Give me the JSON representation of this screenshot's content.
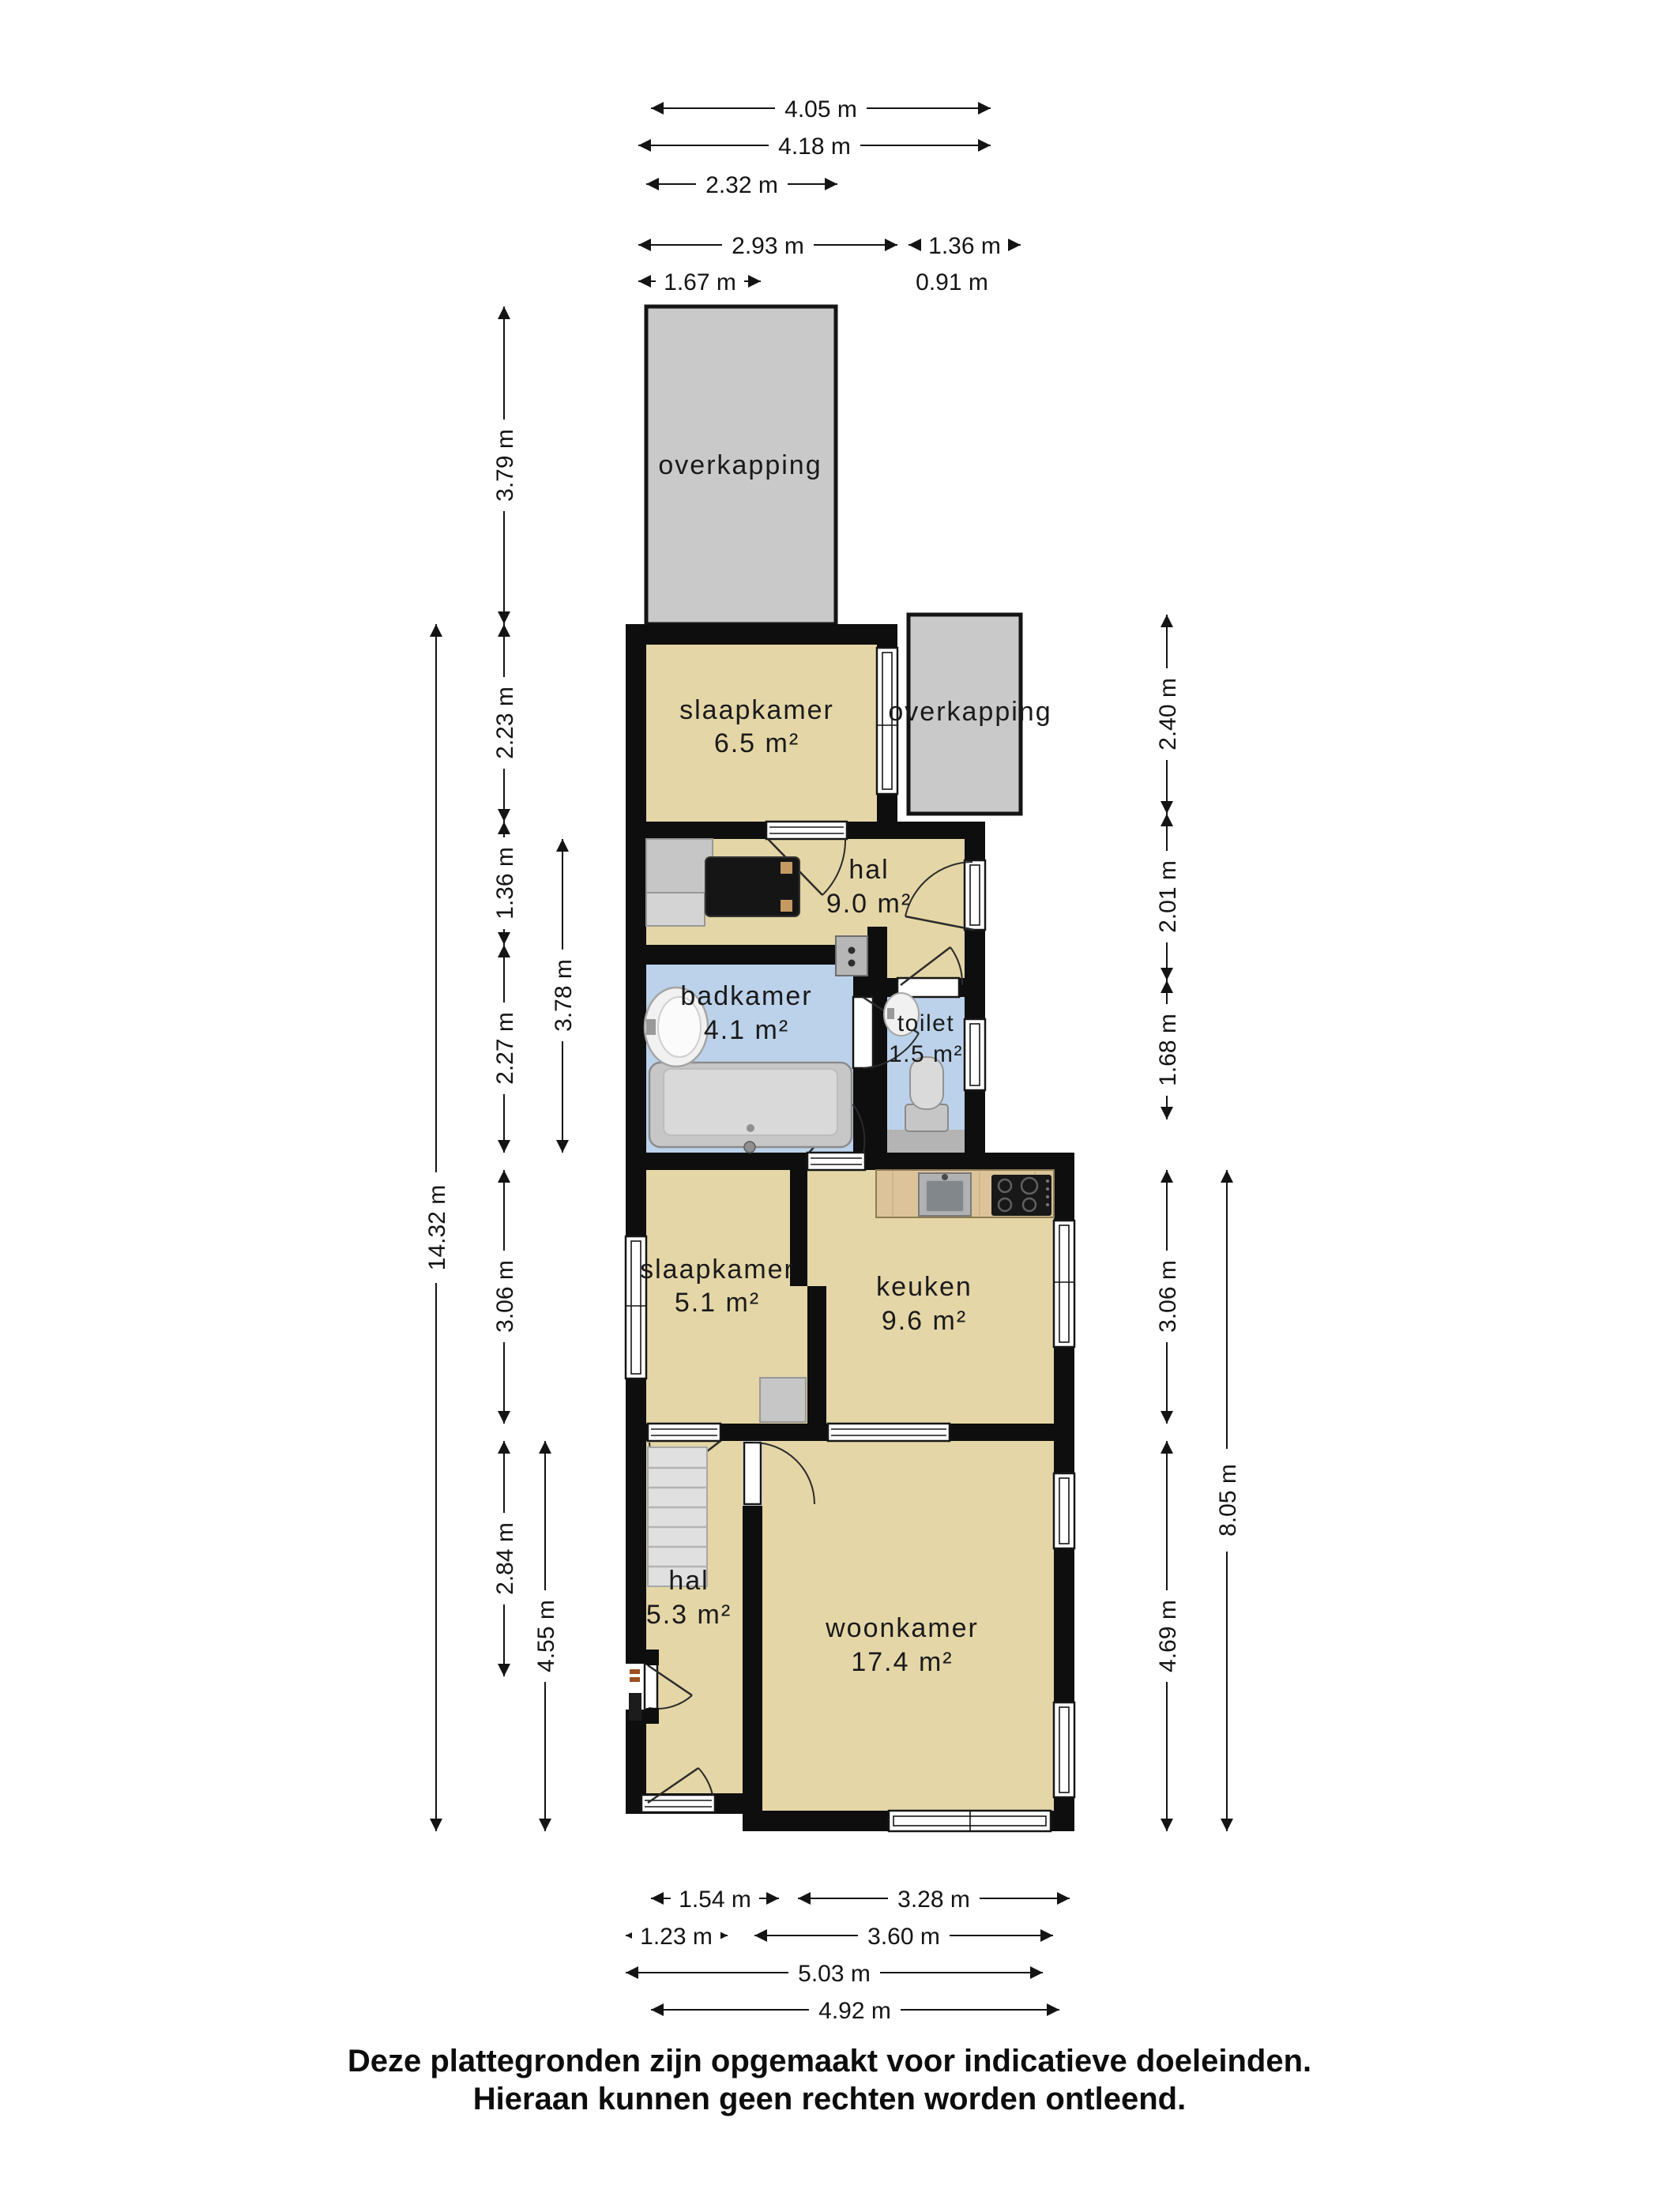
{
  "plan_title": "plattegrond begane grond",
  "footer": {
    "line1": "Deze plattegronden zijn opgemaakt voor indicatieve doeleinden.",
    "line2": "Hieraan kunnen geen rechten worden ontleend."
  },
  "colors": {
    "floor": "#e4d6a6",
    "wall": "#0e0e0e",
    "wet_room": "#bcd2ea",
    "overkapping": "#c9c9c9",
    "counter_wood": "#dcc39a",
    "fixture_gray": "#c7c7c7"
  },
  "rooms": {
    "overkapping_top": {
      "name": "overkapping"
    },
    "slaapkamer_1": {
      "name": "slaapkamer",
      "area": "6.5 m²"
    },
    "overkapping_right": {
      "name": "overkapping"
    },
    "hal_1": {
      "name": "hal",
      "area": "9.0 m²"
    },
    "badkamer": {
      "name": "badkamer",
      "area": "4.1 m²"
    },
    "toilet": {
      "name": "toilet",
      "area": "1.5 m²"
    },
    "slaapkamer_2": {
      "name": "slaapkamer",
      "area": "5.1 m²"
    },
    "keuken": {
      "name": "keuken",
      "area": "9.6 m²"
    },
    "hal_2": {
      "name": "hal",
      "area": "5.3 m²"
    },
    "woonkamer": {
      "name": "woonkamer",
      "area": "17.4 m²"
    }
  },
  "dimensions": {
    "top": [
      "4.05 m",
      "4.18 m",
      "2.32 m",
      "2.93 m",
      "1.36 m",
      "1.67 m",
      "0.91 m"
    ],
    "left": [
      "3.79 m",
      "2.23 m",
      "1.36 m",
      "2.27 m",
      "3.78 m",
      "14.32 m",
      "3.06 m",
      "2.84 m",
      "4.55 m"
    ],
    "right": [
      "2.40 m",
      "2.01 m",
      "1.68 m",
      "3.06 m",
      "8.05 m",
      "4.69 m"
    ],
    "bottom": [
      "1.54 m",
      "3.28 m",
      "1.23 m",
      "3.60 m",
      "5.03 m",
      "4.92 m"
    ]
  }
}
